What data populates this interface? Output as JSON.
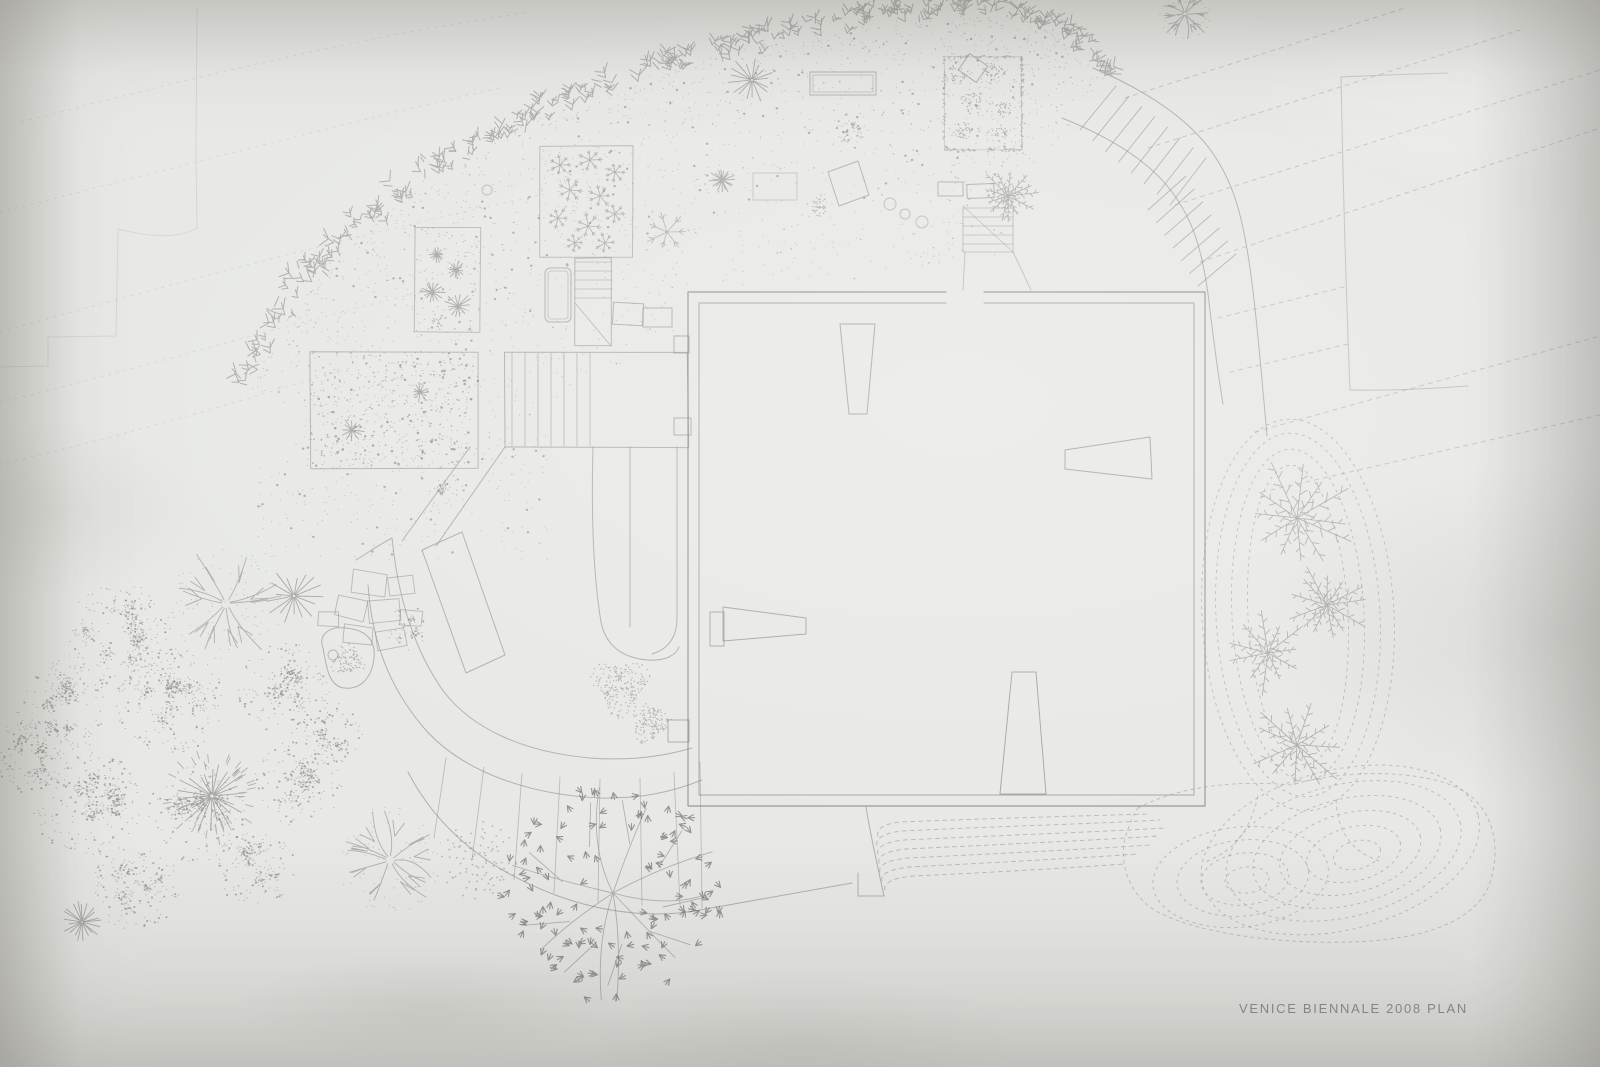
{
  "meta": {
    "title": "Hand-drawn pencil site plan on paper"
  },
  "caption": {
    "text": "VENICE BIENNALE 2008 PLAN",
    "x": 1239,
    "y": 1013,
    "size": 13,
    "spacing": 1.7
  },
  "palette": {
    "paper": "#e8e9e6",
    "pencil": "#8b8c88",
    "pencil_dark": "#6f706e",
    "pencil_faint": "#b0b1ad",
    "caption_ink": "#84858a"
  },
  "canvas": {
    "w": 1600,
    "h": 1067,
    "seed": 11
  },
  "drawing": {
    "faint_steps": "M197,8 L196,150 L197,228 C176,240 146,236 118,229 L116,336 L48,337 L48,366 L0,367",
    "faint_curves": [
      "M22,122 C160,86 340,40 530,12",
      "M0,212 C130,180 320,128 500,88",
      "M0,332 C150,290 340,238 545,194",
      "M0,402 C130,372 270,328 430,290",
      "M0,464 C110,440 230,404 350,368"
    ],
    "topright_rect": [
      "M1341,77 C1380,75 1414,74 1448,73",
      "M1341,77 C1343,180 1346,290 1350,390",
      "M1350,390 C1395,391 1440,388 1468,386"
    ],
    "topright_dashes": [
      [
        1125,
        98,
        1405,
        8
      ],
      [
        1148,
        148,
        1520,
        30
      ],
      [
        1175,
        205,
        1600,
        70
      ],
      [
        1200,
        262,
        1600,
        128
      ],
      [
        1218,
        318,
        1348,
        286
      ],
      [
        1230,
        372,
        1348,
        344
      ],
      [
        1255,
        432,
        1600,
        336
      ],
      [
        1262,
        492,
        1600,
        415
      ]
    ],
    "band": {
      "centerline": [
        [
          243,
          388
        ],
        [
          290,
          300
        ],
        [
          352,
          232
        ],
        [
          436,
          168
        ],
        [
          540,
          112
        ],
        [
          660,
          66
        ],
        [
          788,
          32
        ],
        [
          900,
          13
        ],
        [
          990,
          8
        ],
        [
          1056,
          26
        ],
        [
          1112,
          72
        ]
      ],
      "glyphs": 235,
      "halfwidth": 17
    },
    "field": {
      "count": 1500,
      "dark": 140,
      "depth": 250,
      "patch": [
        258,
        436,
        290,
        124
      ],
      "patch_count": 260
    },
    "building": {
      "outer": "M946,292 L688,292 L688,806 L1205,806 L1205,292 L984,292",
      "inner": "M946,303 L699,303 L699,795 L1194,795 L1194,303 L984,303",
      "wedges": [
        "M840,324 L875,324 L867,414 L849,414 Z",
        "M1065,450 L1150,437 L1152,479 L1065,469 Z",
        "M723,607 L806,618 L806,634 L723,641 Z",
        "M1012,672 L1036,672 L1046,794 L1000,794 Z"
      ],
      "blocks": [
        [
          710,
          612,
          14,
          34
        ],
        [
          674,
          336,
          15,
          17
        ],
        [
          674,
          418,
          17,
          17
        ],
        [
          668,
          720,
          21,
          22
        ]
      ]
    },
    "stairs_main": {
      "b1": "M1093,68 C1150,92 1192,122 1214,155 C1235,186 1243,220 1250,268 C1257,318 1260,360 1264,402 L1267,436",
      "b2": "M1062,118 C1112,138 1150,162 1172,192 C1193,220 1202,250 1208,294 C1213,336 1218,374 1223,404",
      "flightA": {
        "top": [
          1116,
          86,
          1206,
          158
        ],
        "bot": [
          1080,
          130,
          1170,
          205
        ],
        "n": 8
      },
      "flightB": {
        "top": [
          1186,
          176,
          1236,
          254
        ],
        "bot": [
          1148,
          210,
          1198,
          286
        ],
        "n": 7
      }
    },
    "stair_s2": {
      "rect": [
        575,
        258,
        37,
        88
      ],
      "treads": [
        262,
        271,
        280,
        289,
        298
      ],
      "diag": [
        575,
        303,
        611,
        346
      ]
    },
    "stair_s4": {
      "x": 963,
      "w": 50,
      "treads": [
        208,
        217,
        226,
        235,
        244,
        252
      ],
      "diag": [
        963,
        206,
        1013,
        252
      ],
      "below": [
        "M965,252 L963,290",
        "M1013,252 L1031,290"
      ]
    },
    "terrace": {
      "rect": [
        505,
        352,
        183,
        95
      ],
      "stair_x": [
        512,
        525,
        538,
        551,
        564,
        577
      ],
      "div_x": 590
    },
    "walkway_paths": [
      "M356,560 C372,550 382,543 392,538 C398,598 414,650 444,692 C472,728 522,752 590,758 C630,761 662,757 692,748",
      "M368,585 C372,640 388,686 424,728 C462,772 530,795 600,798 C640,799 672,792 702,780",
      "M408,772 C438,830 488,870 558,896 C608,914 658,918 700,910 C760,899 810,890 852,883",
      "M422,550 L462,532 L505,655 L466,673 Z",
      "M505,447 L436,546",
      "M470,447 L402,541",
      "M593,447 C591,520 594,580 601,622 C606,646 622,658 648,660 C666,661 676,655 679,647",
      "M630,447 L630,627",
      "M677,447 L677,618 C677,638 668,649 652,654"
    ],
    "ticks": [
      [
        446,
        758,
        434,
        838
      ],
      [
        484,
        767,
        472,
        860
      ],
      [
        522,
        773,
        514,
        880
      ],
      [
        560,
        777,
        554,
        893
      ],
      [
        600,
        779,
        598,
        902
      ],
      [
        640,
        778,
        642,
        905
      ],
      [
        674,
        772,
        680,
        905
      ],
      [
        700,
        762,
        702,
        908
      ]
    ],
    "apron": [
      "M866,807 C871,838 878,868 884,896",
      "M884,896 L858,896 L858,873"
    ],
    "benches": [
      {
        "x": 810,
        "y": 72,
        "w": 66,
        "h": 23,
        "rot": 0,
        "double": true,
        "round": 0
      },
      {
        "x": 938,
        "y": 182,
        "w": 25,
        "h": 14,
        "rot": 0,
        "double": false,
        "round": 0
      },
      {
        "x": 967,
        "y": 184,
        "w": 27,
        "h": 14,
        "rot": -2,
        "double": false,
        "round": 0
      },
      {
        "x": 545,
        "y": 268,
        "w": 26,
        "h": 54,
        "rot": 0,
        "double": true,
        "round": 5
      },
      {
        "x": 613,
        "y": 303,
        "w": 30,
        "h": 22,
        "rot": 3,
        "double": false,
        "round": 0
      },
      {
        "x": 643,
        "y": 308,
        "w": 29,
        "h": 19,
        "rot": 0,
        "double": false,
        "round": 0
      },
      {
        "x": 962,
        "y": 58,
        "w": 22,
        "h": 20,
        "rot": 35,
        "double": false,
        "round": 0
      },
      {
        "x": 753,
        "y": 173,
        "w": 44,
        "h": 27,
        "rot": 0,
        "double": false,
        "round": 0
      }
    ],
    "planter": "M828,172 L858,161 L869,195 L839,206 Z",
    "stones": [
      [
        352,
        572,
        34,
        22,
        8
      ],
      [
        388,
        576,
        26,
        18,
        -6
      ],
      [
        336,
        598,
        30,
        20,
        14
      ],
      [
        368,
        600,
        32,
        22,
        -4
      ],
      [
        344,
        626,
        28,
        18,
        6
      ],
      [
        376,
        630,
        30,
        18,
        -10
      ],
      [
        400,
        610,
        22,
        16,
        4
      ],
      [
        318,
        612,
        20,
        14,
        0
      ]
    ],
    "pond": {
      "path": "M323,648 C318,634 330,626 346,628 C366,630 376,640 374,658 C372,678 360,690 344,688 C328,686 326,664 323,648 Z",
      "circle": [
        333,
        655,
        5
      ],
      "moss": [
        348,
        660,
        15
      ]
    },
    "circles": [
      [
        890,
        204,
        6
      ],
      [
        905,
        214,
        5
      ],
      [
        922,
        222,
        6
      ],
      [
        487,
        190,
        5
      ]
    ],
    "plots": {
      "p1": {
        "rect": [
          415,
          228,
          65,
          104
        ],
        "stars": [
          [
            437,
            255,
            8
          ],
          [
            456,
            270,
            9
          ],
          [
            432,
            292,
            13
          ],
          [
            458,
            306,
            15
          ]
        ],
        "moss": [
          [
            440,
            322,
            7
          ]
        ],
        "dots": 80
      },
      "p2": {
        "rect": [
          540,
          146,
          93,
          112
        ],
        "flakes": [
          [
            560,
            165,
            11
          ],
          [
            590,
            160,
            12
          ],
          [
            615,
            172,
            10
          ],
          [
            570,
            190,
            13
          ],
          [
            600,
            196,
            12
          ],
          [
            558,
            218,
            11
          ],
          [
            588,
            226,
            13
          ],
          [
            615,
            214,
            10
          ],
          [
            575,
            243,
            9
          ],
          [
            605,
            243,
            10
          ]
        ],
        "dots": 60
      },
      "p3": {
        "rect": [
          310,
          352,
          168,
          116
        ],
        "stars": [
          [
            352,
            430,
            12
          ],
          [
            420,
            392,
            10
          ]
        ],
        "dots": 430
      },
      "p4": {
        "rect": [
          944,
          57,
          78,
          93
        ],
        "moss": [
          [
            958,
            75,
            9
          ],
          [
            993,
            72,
            10
          ],
          [
            972,
            102,
            11
          ],
          [
            1005,
            110,
            9
          ],
          [
            962,
            130,
            10
          ],
          [
            1000,
            134,
            9
          ]
        ],
        "border_dots": 180,
        "dots": 40
      }
    },
    "trees": [
      {
        "t": "branch",
        "x": 226,
        "y": 604,
        "r": 56
      },
      {
        "t": "stipple",
        "x": 118,
        "y": 636,
        "r": 54
      },
      {
        "t": "stipple",
        "x": 62,
        "y": 706,
        "r": 46
      },
      {
        "t": "stipple",
        "x": 170,
        "y": 702,
        "r": 54
      },
      {
        "t": "stipple",
        "x": 86,
        "y": 800,
        "r": 56
      },
      {
        "t": "stipple",
        "x": 196,
        "y": 812,
        "r": 50
      },
      {
        "t": "stipple",
        "x": 284,
        "y": 688,
        "r": 46
      },
      {
        "t": "stipple",
        "x": 298,
        "y": 782,
        "r": 44
      },
      {
        "t": "stipple",
        "x": 28,
        "y": 758,
        "r": 38
      },
      {
        "t": "stipple",
        "x": 136,
        "y": 888,
        "r": 44
      },
      {
        "t": "stipple",
        "x": 256,
        "y": 868,
        "r": 40
      },
      {
        "t": "stipple",
        "x": 330,
        "y": 734,
        "r": 32
      },
      {
        "t": "star",
        "x": 294,
        "y": 596,
        "r": 28
      },
      {
        "t": "dandelion",
        "x": 212,
        "y": 796,
        "r": 44
      },
      {
        "t": "star",
        "x": 82,
        "y": 922,
        "r": 20
      },
      {
        "t": "branch",
        "x": 390,
        "y": 860,
        "r": 54
      },
      {
        "t": "dotburst",
        "x": 479,
        "y": 860,
        "r": 38
      },
      {
        "t": "leafy",
        "x": 613,
        "y": 893,
        "r": 104
      },
      {
        "t": "stipple",
        "x": 408,
        "y": 628,
        "r": 22
      },
      {
        "t": "moss",
        "x": 620,
        "y": 686,
        "r": 26
      },
      {
        "t": "moss",
        "x": 650,
        "y": 722,
        "r": 19
      },
      {
        "t": "stipple",
        "x": 447,
        "y": 492,
        "r": 19
      },
      {
        "t": "palm",
        "x": 1297,
        "y": 518,
        "r": 54
      },
      {
        "t": "palm",
        "x": 1327,
        "y": 605,
        "r": 38
      },
      {
        "t": "palm",
        "x": 1268,
        "y": 653,
        "r": 40
      },
      {
        "t": "palm",
        "x": 1297,
        "y": 745,
        "r": 50
      },
      {
        "t": "palm",
        "x": 1008,
        "y": 196,
        "r": 28
      },
      {
        "t": "star",
        "x": 752,
        "y": 80,
        "r": 24
      },
      {
        "t": "star",
        "x": 722,
        "y": 180,
        "r": 13
      },
      {
        "t": "snowflake",
        "x": 667,
        "y": 232,
        "r": 20
      },
      {
        "t": "stipple",
        "x": 852,
        "y": 132,
        "r": 20
      },
      {
        "t": "branch",
        "x": 1185,
        "y": 14,
        "r": 26
      },
      {
        "t": "moss",
        "x": 818,
        "y": 206,
        "r": 10
      }
    ],
    "contours": {
      "loops": {
        "cx": 1298,
        "cy": 615,
        "rings": [
          [
            50,
            150
          ],
          [
            66,
            166
          ],
          [
            82,
            182
          ],
          [
            96,
            196
          ]
        ],
        "rot": -3
      },
      "loop_tails": [
        "M1258,796 C1250,830 1236,850 1205,862",
        "M1336,800 C1338,834 1352,852 1382,862"
      ],
      "swirl1": {
        "cx": 1247,
        "cy": 880,
        "rings": [
          [
            22,
            13
          ],
          [
            44,
            26
          ],
          [
            66,
            38
          ],
          [
            88,
            50
          ]
        ],
        "rot": -6
      },
      "swirl2": {
        "cx": 1357,
        "cy": 855,
        "rings": [
          [
            24,
            14
          ],
          [
            48,
            27
          ],
          [
            72,
            40
          ],
          [
            96,
            53
          ],
          [
            120,
            66
          ],
          [
            142,
            80
          ]
        ],
        "rot": -14
      },
      "envelope": "M1138,808 C1180,786 1235,780 1292,785 C1340,770 1420,768 1462,790 C1496,810 1502,852 1488,888 C1470,924 1420,940 1350,942 C1280,944 1200,934 1158,912 C1128,896 1118,860 1126,835 C1131,820 1135,812 1138,808",
      "flows": [
        "M878,836 C876,830 882,824 900,822 C1000,818 1080,816 1148,814",
        "M877,845 C875,839 883,833 902,831 C1005,826 1090,824 1160,820",
        "M878,854 C876,848 884,842 904,840 C1010,835 1095,832 1166,828",
        "M879,863 C877,857 885,851 906,849 C1012,844 1098,840 1158,836",
        "M880,872 C878,866 886,860 908,858 C1010,853 1090,849 1150,845",
        "M882,881 C880,875 888,869 910,867 C1005,862 1080,858 1138,854",
        "M885,890 C883,884 891,878 913,876 C1000,872 1068,868 1124,864"
      ]
    }
  }
}
